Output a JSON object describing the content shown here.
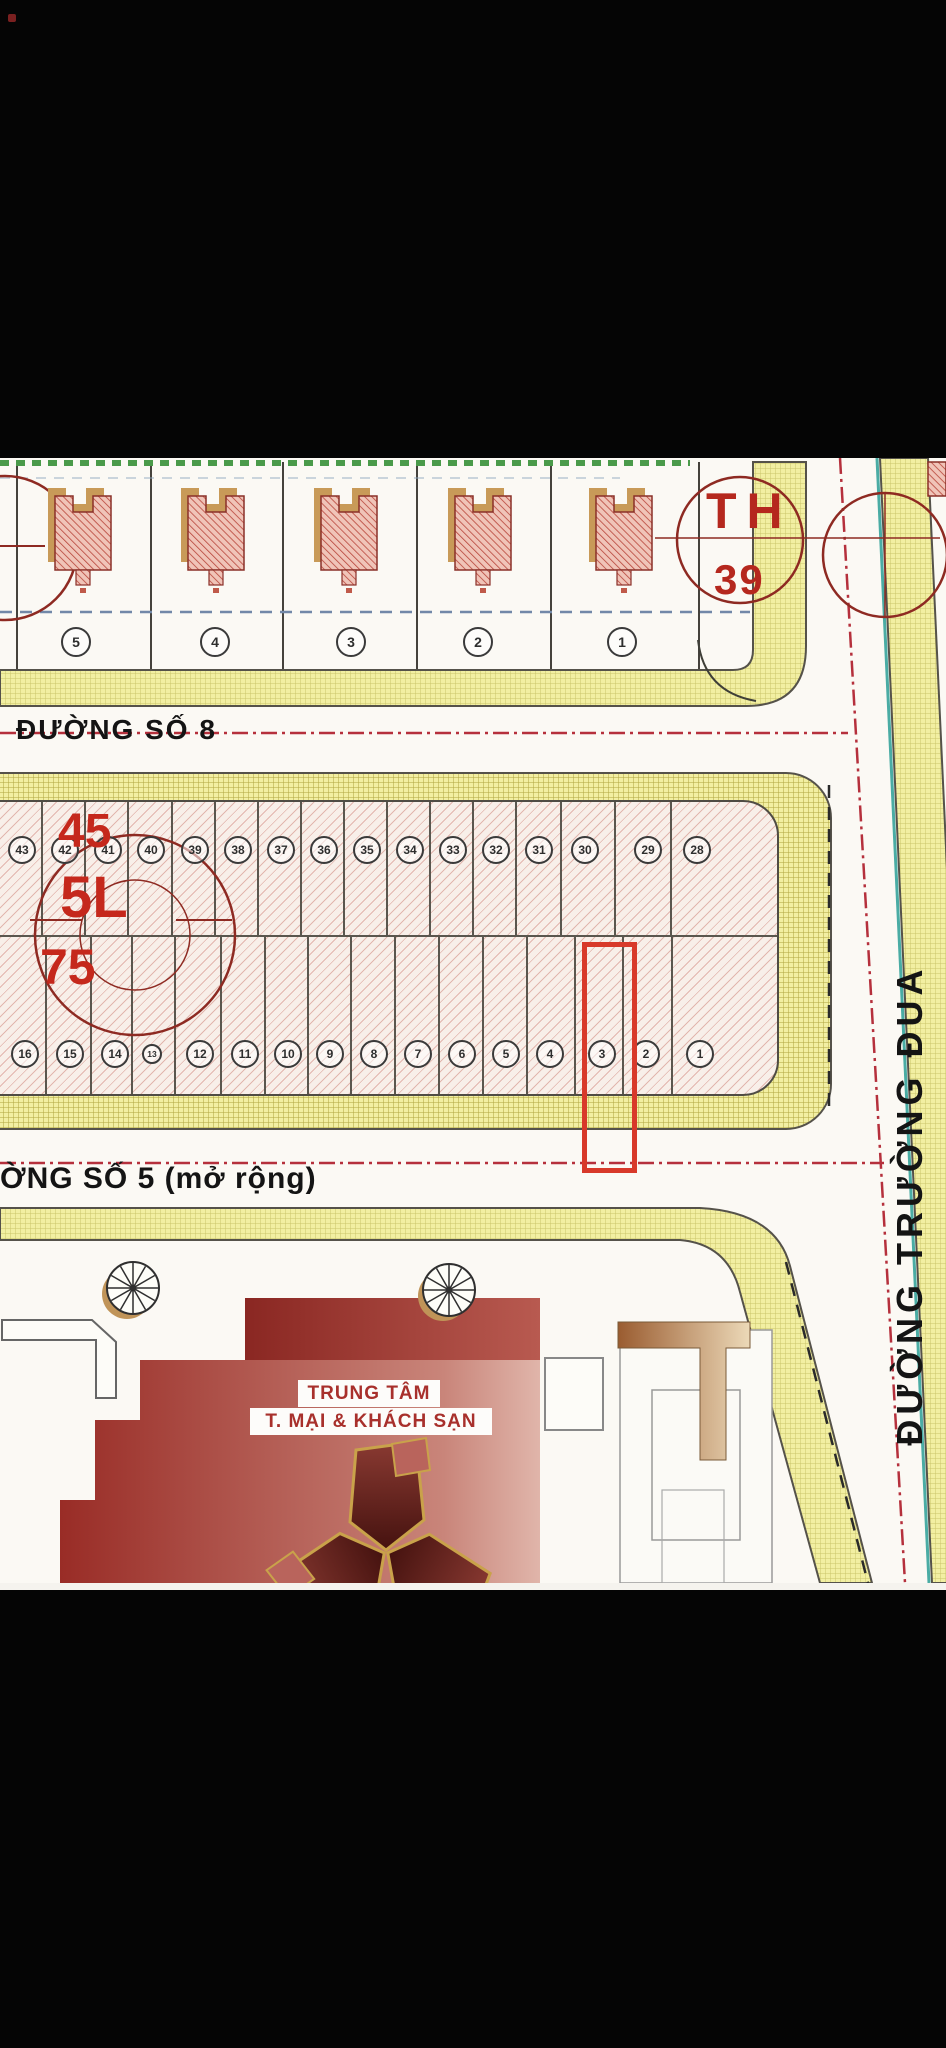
{
  "streets": {
    "road8": "ĐƯỜNG SỐ 8",
    "road5": "ỜNG SỐ 5 (mở rộng)",
    "east": "ĐƯỜNG TRƯỜNG ĐUA"
  },
  "annotations": {
    "block_code": "TH",
    "block_number": "39",
    "num_45": "45",
    "code_5l": "5L",
    "num_75": "75"
  },
  "top_block_plots": [
    "5",
    "4",
    "3",
    "2",
    "1"
  ],
  "middle_block": {
    "top_row": [
      "43",
      "42",
      "41",
      "40",
      "39",
      "38",
      "37",
      "36",
      "35",
      "34",
      "33",
      "32",
      "31",
      "30",
      "29",
      "28"
    ],
    "bottom_row": [
      "16",
      "15",
      "14",
      "13",
      "12",
      "11",
      "10",
      "9",
      "8",
      "7",
      "6",
      "5",
      "4",
      "3",
      "2",
      "1"
    ],
    "highlighted_plot": "3"
  },
  "hotel": {
    "line1": "TRUNG TÂM",
    "line2": "T. MẠI & KHÁCH SẠN"
  },
  "colors": {
    "annotation_red": "#b5281e",
    "highlight_red": "#d8392a",
    "sidewalk_yellow": "#f2efa2",
    "teal_line": "#4aaca4",
    "green_boundary": "#4a9a4a"
  }
}
